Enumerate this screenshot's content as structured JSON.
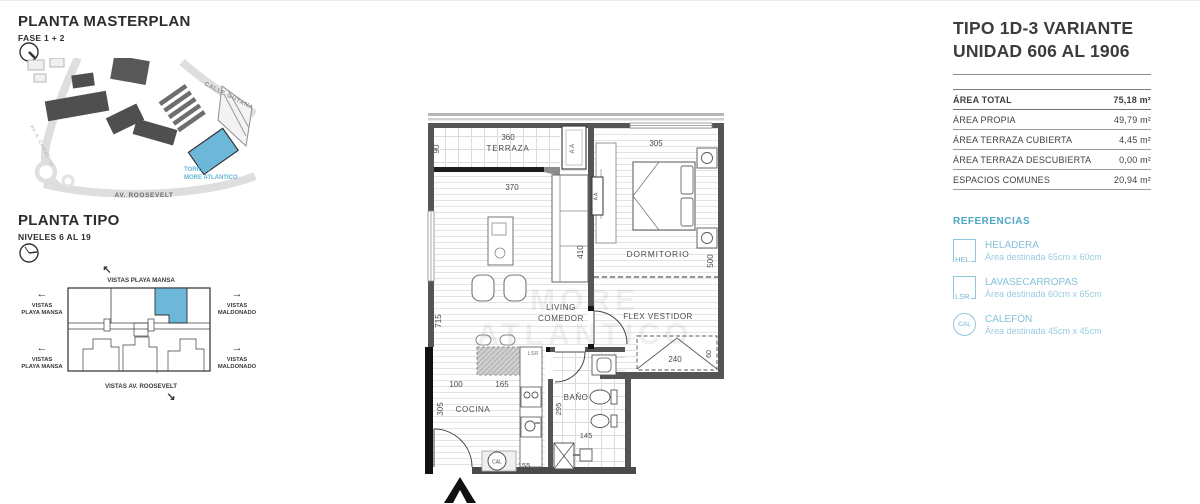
{
  "colors": {
    "accent_blue": "#69b4d6",
    "ref_blue": "#86c2da",
    "text_dark": "#3c3c3c",
    "wall_gray": "#555555"
  },
  "masterplan": {
    "title": "PLANTA MASTERPLAN",
    "phase": "FASE 1 + 2",
    "street_guyana": "CALLE GUYANA",
    "street_camacho": "AV. A. CAMACHO",
    "street_roosevelt": "AV. ROOSEVELT",
    "tower_line1": "TORRE 1",
    "tower_line2": "MORE ATLANTICO"
  },
  "planta_tipo": {
    "title": "PLANTA TIPO",
    "levels": "NIVELES 6 AL 19",
    "vistas_top": "VISTAS PLAYA MANSA",
    "vistas_left_1": "VISTAS",
    "vistas_left_2": "PLAYA MANSA",
    "vistas_right_1": "VISTAS",
    "vistas_right_2": "MALDONADO",
    "vistas_bottom": "VISTAS AV. ROOSEVELT",
    "arrow_left": "←",
    "arrow_right": "→",
    "arrow_up_left": "↖",
    "arrow_down_right": "↘"
  },
  "floorplan": {
    "watermark": "MORE ATLÁNTICO",
    "terraza": {
      "label": "TERRAZA",
      "dim_w": "360",
      "dim_d": "90"
    },
    "living": {
      "label_1": "LIVING",
      "label_2": "COMEDOR",
      "dim_w": "370",
      "dim_d": "410",
      "dim_side": "715"
    },
    "dormitorio": {
      "label": "DORMITORIO",
      "dim_w": "305",
      "dim_d": "500"
    },
    "flex_vestidor": {
      "label": "FLEX VESTIDOR",
      "dim_closet_w": "240",
      "dim_closet_d": "60"
    },
    "cocina": {
      "label": "COCINA",
      "dim_1": "100",
      "dim_2": "165",
      "dim_d": "305",
      "dim_3": "155"
    },
    "bano": {
      "label": "BAÑO",
      "dim_d": "295",
      "dim_w": "145"
    },
    "equipment": {
      "aa": "AA",
      "lsr": "LSR",
      "cal": "CAL"
    }
  },
  "info_panel": {
    "title_line1": "TIPO 1D-3 VARIANTE",
    "title_line2": "UNIDAD 606 AL 1906",
    "rows": [
      {
        "label": "ÁREA TOTAL",
        "value": "75,18 m²"
      },
      {
        "label": "ÁREA PROPIA",
        "value": "49,79 m²"
      },
      {
        "label": "ÁREA TERRAZA CUBIERTA",
        "value": "4,45 m²"
      },
      {
        "label": "ÁREA TERRAZA DESCUBIERTA",
        "value": "0,00 m²"
      },
      {
        "label": "ESPACIOS COMUNES",
        "value": "20,94 m²"
      }
    ],
    "referencias": {
      "heading": "REFERENCIAS",
      "items": [
        {
          "code": "HEL",
          "name": "HELADERA",
          "desc": "Área destinada 65cm x 60cm"
        },
        {
          "code": "LSR",
          "name": "LAVASECARROPAS",
          "desc": "Área destinada 60cm x 65cm"
        },
        {
          "code": "CAL",
          "name": "CALEFÓN",
          "desc": "Área destinada 45cm x 45cm"
        }
      ]
    }
  }
}
